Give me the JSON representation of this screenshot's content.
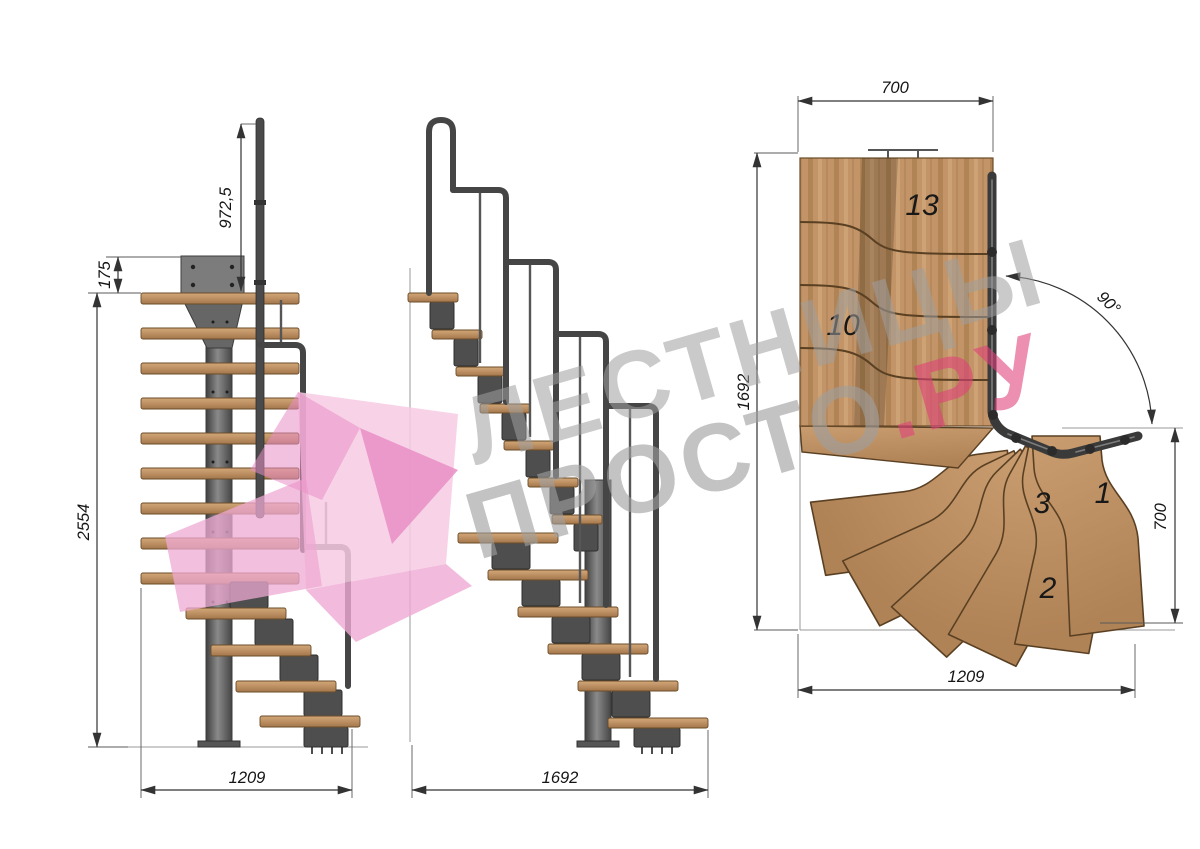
{
  "watermark": {
    "line1": "ЛЕСТНИЦЫ",
    "line2_gray": "ПРОСТО",
    "line2_accent": ".РУ"
  },
  "front_view": {
    "dim_rail_height": "972,5",
    "dim_plate_offset": "175",
    "dim_total_height": "2554",
    "dim_width": "1209"
  },
  "side_view": {
    "dim_length": "1692"
  },
  "plan_view": {
    "dim_top_width": "700",
    "dim_left_length": "1692",
    "dim_angle": "90°",
    "dim_right_width": "700",
    "dim_bottom_length": "1209",
    "step_top": "13",
    "step_mid": "10",
    "step_3": "3",
    "step_1": "1",
    "step_2": "2"
  },
  "colors": {
    "bg": "#ffffff",
    "wood": "#c29467",
    "wood-edge": "#6b4c2a",
    "metal": "#4e4e4e",
    "metal-dark": "#2f2f2f",
    "dim-line": "#333333",
    "wm-gray": "#9f9f9f",
    "wm-accent": "#e0417b",
    "wm-pink-light": "#f7cbe3",
    "wm-pink": "#efa9d3",
    "wm-pink-dark": "#e98ec6"
  }
}
